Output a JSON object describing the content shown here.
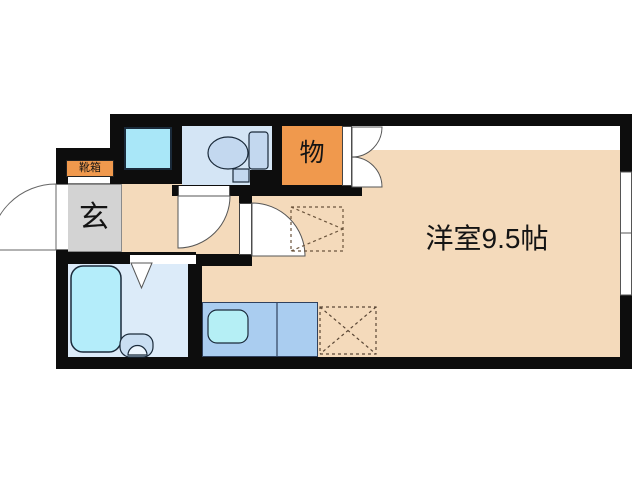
{
  "floorplan": {
    "title_note": "studio apartment floor plan",
    "labels": {
      "entrance": "玄",
      "shoe_box": "靴箱",
      "storage": "物",
      "main_room": "洋室9.5帖"
    },
    "colors": {
      "wall": "#0d0d0d",
      "floor": "#f4dabb",
      "storage_fill": "#f0994d",
      "shoe_box_fill": "#f0994d",
      "entrance_fill": "#d3d3d3",
      "toilet_room_fill": "#d4e5f5",
      "bathroom_fill": "#dcebf9",
      "bathtub_fill": "#b4edfa",
      "washing_pan_fill": "#a9e7f8",
      "kitchen_counter_fill": "#aacdf0",
      "kitchen_sink_fill": "#b5eff5",
      "dashed_marker": "#6b543c"
    },
    "fixtures": [
      "entrance-door-arc",
      "toilet-door-arc",
      "main-room-door-arc",
      "closet-double-door-arcs",
      "folding-bath-door",
      "bathtub",
      "toilet",
      "washbasin",
      "kitchen-sink",
      "washing-machine-pan",
      "equipment-space-dashed",
      "refrigerator-space-dashed",
      "window"
    ]
  }
}
